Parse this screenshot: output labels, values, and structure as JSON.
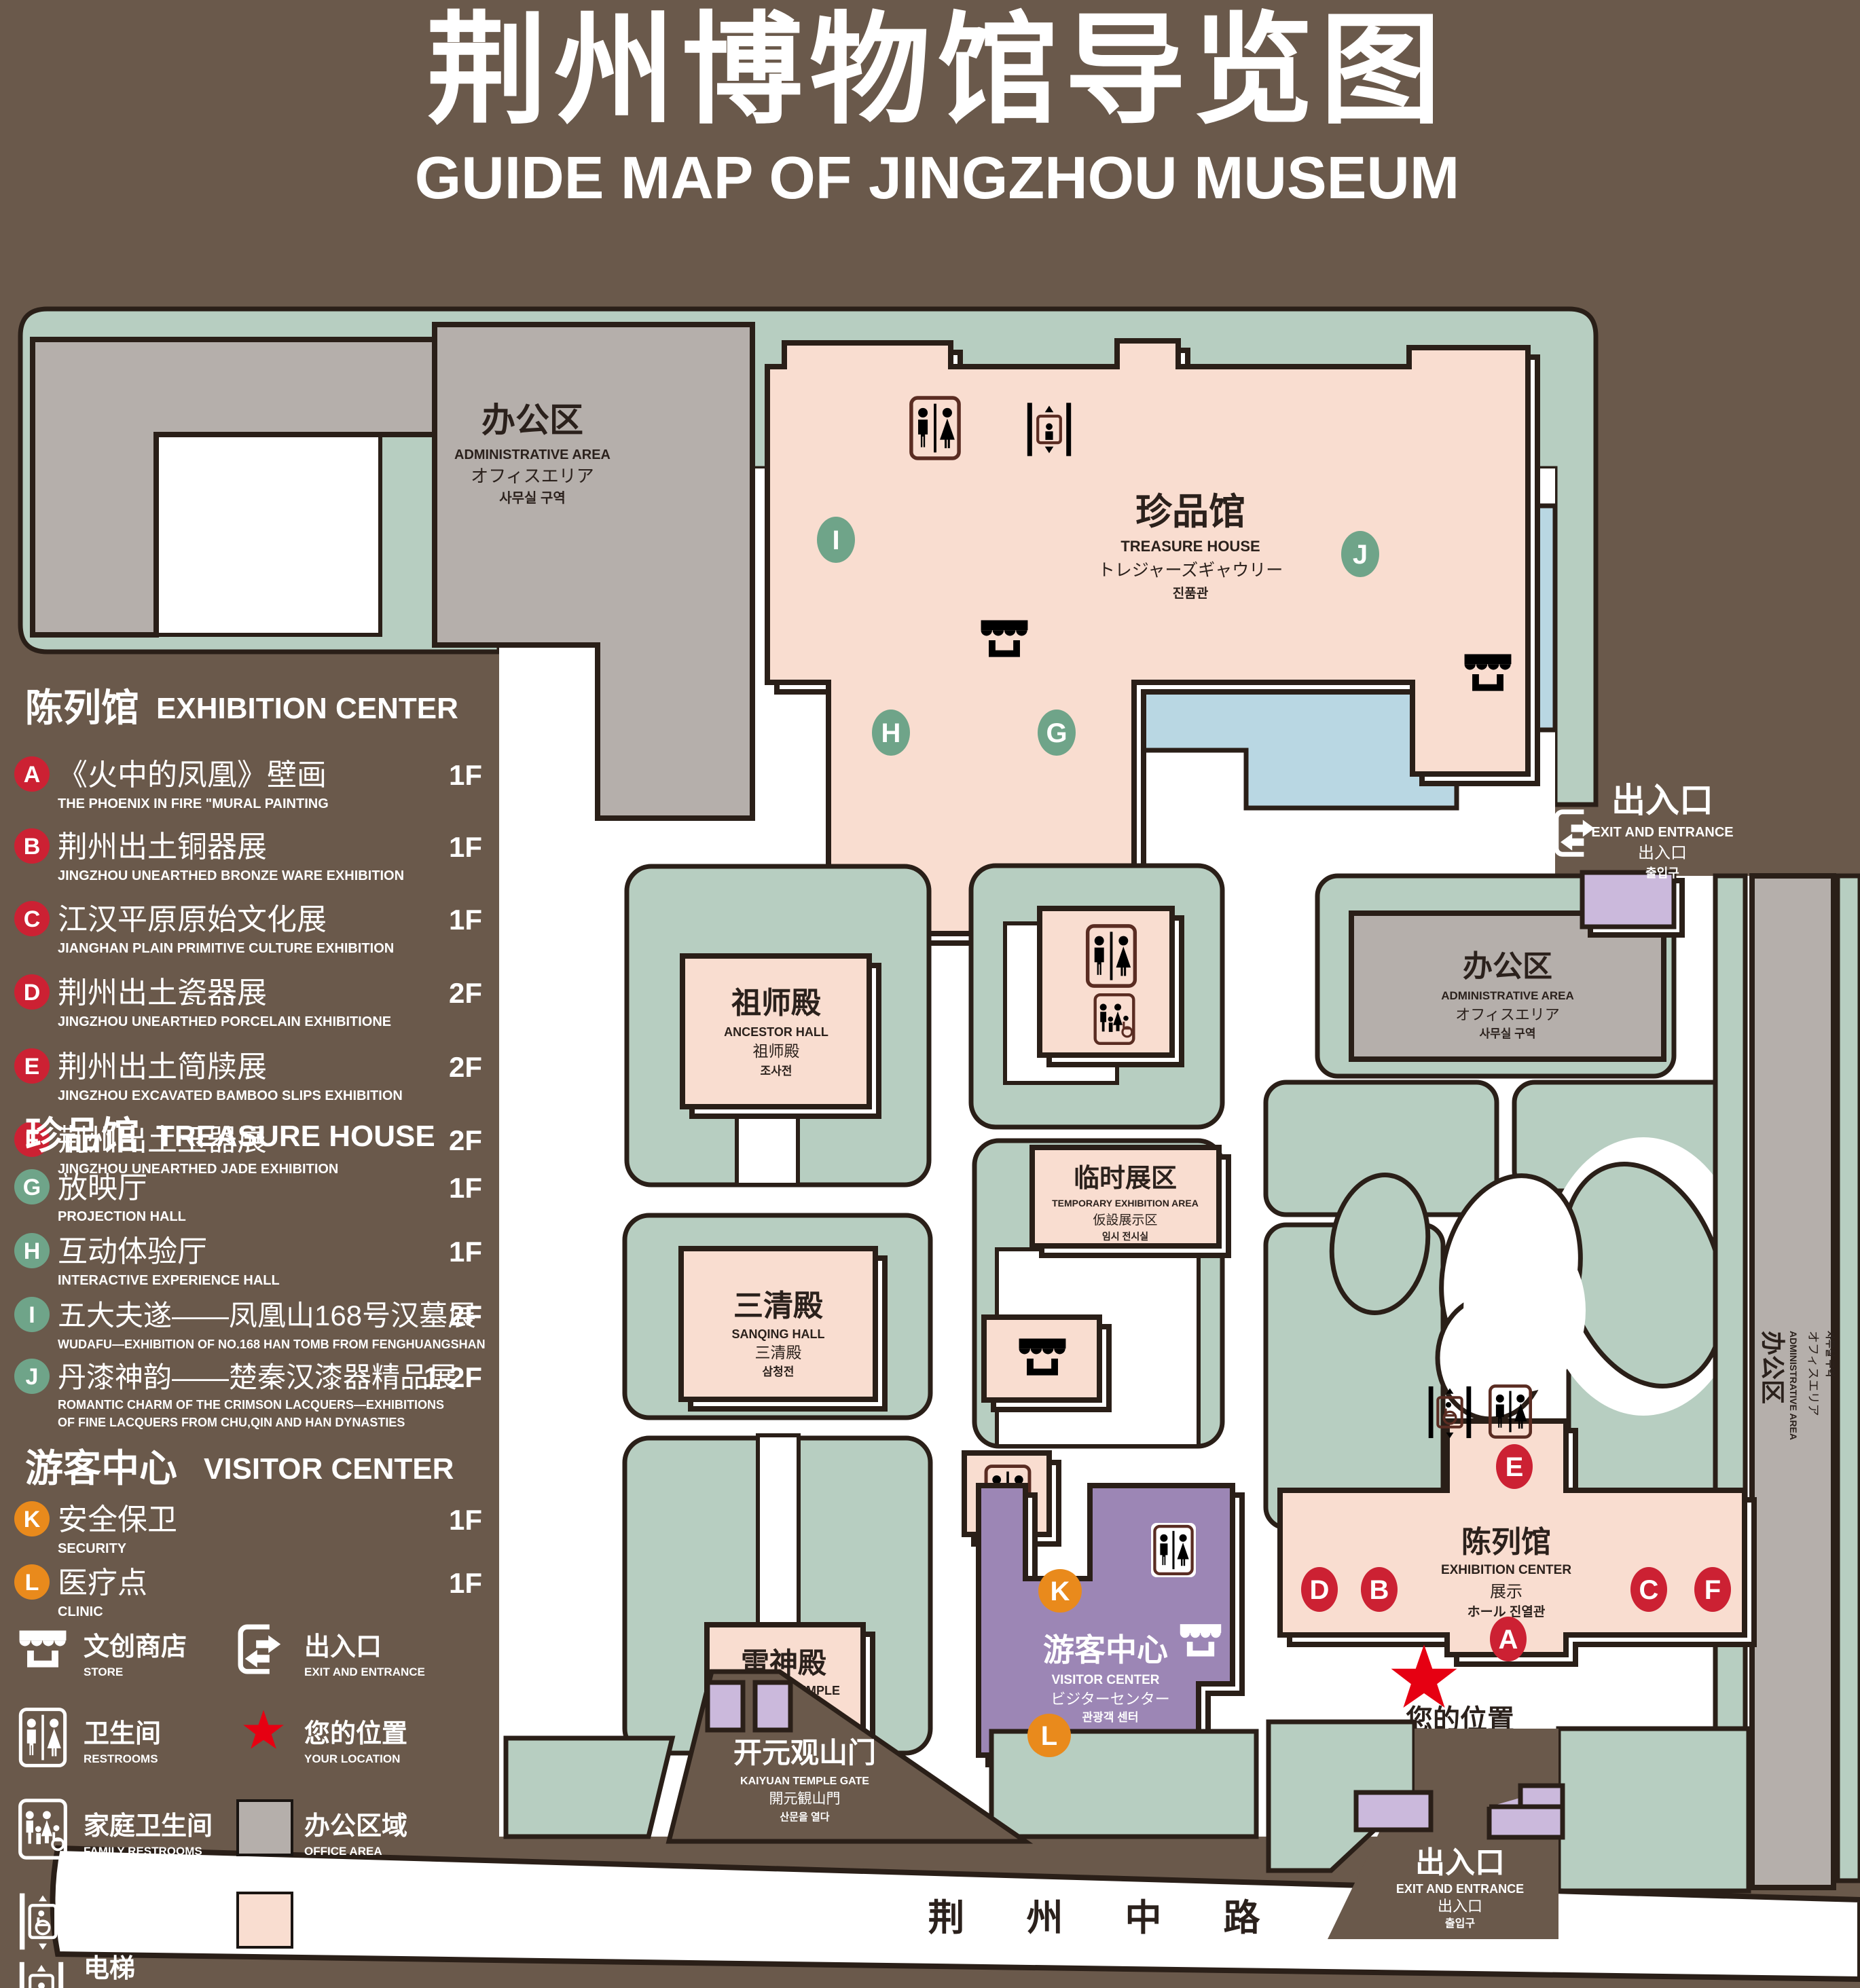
{
  "title": {
    "zh": "荆州博物馆导览图",
    "en": "GUIDE MAP OF JINGZHOU MUSEUM"
  },
  "legend": {
    "sections": [
      {
        "zh": "陈列馆",
        "en": "EXHIBITION CENTER",
        "badge_color": "#cc2133",
        "items": [
          {
            "letter": "A",
            "zh": "《火中的凤凰》壁画",
            "en": "THE PHOENIX IN FIRE \"MURAL PAINTING",
            "floor": "1F"
          },
          {
            "letter": "B",
            "zh": "荆州出土铜器展",
            "en": "JINGZHOU UNEARTHED BRONZE WARE EXHIBITION",
            "floor": "1F"
          },
          {
            "letter": "C",
            "zh": "江汉平原原始文化展",
            "en": "JIANGHAN PLAIN PRIMITIVE CULTURE EXHIBITION",
            "floor": "1F"
          },
          {
            "letter": "D",
            "zh": "荆州出土瓷器展",
            "en": "JINGZHOU UNEARTHED PORCELAIN EXHIBITIONE",
            "floor": "2F"
          },
          {
            "letter": "E",
            "zh": "荆州出土简牍展",
            "en": "JINGZHOU EXCAVATED BAMBOO SLIPS EXHIBITION",
            "floor": "2F"
          },
          {
            "letter": "F",
            "zh": "荆州出土玉器展",
            "en": "JINGZHOU UNEARTHED JADE EXHIBITION",
            "floor": "2F"
          }
        ]
      },
      {
        "zh": "珍品馆",
        "en": "TREASURE HOUSE",
        "badge_color": "#6fa489",
        "items": [
          {
            "letter": "G",
            "zh": "放映厅",
            "en": "PROJECTION HALL",
            "floor": "1F"
          },
          {
            "letter": "H",
            "zh": "互动体验厅",
            "en": "INTERACTIVE EXPERIENCE HALL",
            "floor": "1F"
          },
          {
            "letter": "I",
            "zh": "五大夫遂——凤凰山168号汉墓展",
            "en": "WUDAFU—EXHIBITION OF NO.168 HAN TOMB FROM FENGHUANGSHAN",
            "floor": "2F"
          },
          {
            "letter": "J",
            "zh": "丹漆神韵——楚秦汉漆器精品展",
            "en": "ROMANTIC CHARM OF THE CRIMSON LACQUERS—EXHIBITIONS",
            "en2": "OF FINE LACQUERS FROM CHU,QIN AND HAN DYNASTIES",
            "floor": "1-2F"
          }
        ]
      },
      {
        "zh": "游客中心",
        "en": "VISITOR CENTER",
        "badge_color": "#e98a1c",
        "items": [
          {
            "letter": "K",
            "zh": "安全保卫",
            "en": "SECURITY",
            "floor": "1F"
          },
          {
            "letter": "L",
            "zh": "医疗点",
            "en": "CLINIC",
            "floor": "1F"
          }
        ]
      }
    ],
    "symbols": [
      {
        "icon": "store-icon",
        "zh": "文创商店",
        "en": "STORE"
      },
      {
        "icon": "exit-icon",
        "zh": "出入口",
        "en": "EXIT AND ENTRANCE"
      },
      {
        "icon": "restrooms-icon",
        "zh": "卫生间",
        "en": "RESTROOMS"
      },
      {
        "icon": "your-location-star",
        "zh": "您的位置",
        "en": "YOUR LOCATION"
      },
      {
        "icon": "family-restrooms-icon",
        "zh": "家庭卫生间",
        "en": "FAMILY RESTROOMS"
      },
      {
        "icon": "office-area-swatch",
        "zh": "办公区域",
        "en": "OFFICE AREA"
      },
      {
        "icon": "accessible-elevator-icon",
        "zh": "无障碍电梯",
        "en": "ACCESSIBLE ELEVATOR"
      },
      {
        "icon": "display-area-swatch",
        "zh": "展示区域",
        "en": "DISPLAY AREA"
      },
      {
        "icon": "elevator-icon",
        "zh": "电梯",
        "en": "Elevator"
      }
    ]
  },
  "map": {
    "labels": {
      "admin": {
        "zh": "办公区",
        "en": "ADMINISTRATIVE AREA",
        "ja": "オフィスエリア",
        "ko": "사무실 구역"
      },
      "treasure": {
        "zh": "珍品馆",
        "en": "TREASURE HOUSE",
        "ja": "トレジャーズギャウリー",
        "ko": "진품관"
      },
      "ancestor": {
        "zh": "祖师殿",
        "en": "ANCESTOR HALL",
        "ja": "祖师殿",
        "ko": "조사전"
      },
      "temporary": {
        "zh": "临时展区",
        "en": "TEMPORARY EXHIBITION AREA",
        "ja": "仮設展示区",
        "ko": "임시 전시실"
      },
      "sanqing": {
        "zh": "三清殿",
        "en": "SANQING HALL",
        "ja": "三清殿",
        "ko": "삼청전"
      },
      "thunder": {
        "zh": "雷神殿",
        "en": "THUNDER TEMPLE",
        "ja": "雷神殿",
        "ko": "뇌신전"
      },
      "visitor": {
        "zh": "游客中心",
        "en": "VISITOR CENTER",
        "ja": "ビジターセンター",
        "ko": "관광객 센터"
      },
      "exhibition": {
        "zh": "陈列馆",
        "en": "EXHIBITION CENTER",
        "ja": "展示",
        "ko": "ホール 진열관"
      },
      "kaiyuan": {
        "zh": "开元观山门",
        "en": "KAIYUAN TEMPLE GATE",
        "ja": "開元観山門",
        "ko": "산문을 열다"
      },
      "exit": {
        "zh": "出入口",
        "en": "EXIT AND ENTRANCE",
        "ja": "出入口",
        "ko": "출입구"
      },
      "your_location": "您的位置",
      "road": "荆 州 中 路"
    },
    "markers": [
      {
        "letter": "A",
        "color": "#cc2133"
      },
      {
        "letter": "B",
        "color": "#cc2133"
      },
      {
        "letter": "C",
        "color": "#cc2133"
      },
      {
        "letter": "D",
        "color": "#cc2133"
      },
      {
        "letter": "E",
        "color": "#cc2133"
      },
      {
        "letter": "F",
        "color": "#cc2133"
      },
      {
        "letter": "G",
        "color": "#6fa489"
      },
      {
        "letter": "H",
        "color": "#6fa489"
      },
      {
        "letter": "I",
        "color": "#6fa489"
      },
      {
        "letter": "J",
        "color": "#6fa489"
      },
      {
        "letter": "K",
        "color": "#e98a1c"
      },
      {
        "letter": "L",
        "color": "#e98a1c"
      }
    ]
  },
  "colors": {
    "background": "#6a594b",
    "green_area": "#b7cec1",
    "display_area_pink": "#f9ddd0",
    "office_area_gray": "#b5afab",
    "pond_blue": "#b9d7e3",
    "visitor_center_purple": "#9c86b5",
    "gate_purple": "#cbb9dc",
    "icon_maroon": "#5a2c22",
    "badge_red": "#cc2133",
    "badge_green": "#6fa489",
    "badge_orange": "#e98a1c",
    "location_red": "#e60012"
  }
}
